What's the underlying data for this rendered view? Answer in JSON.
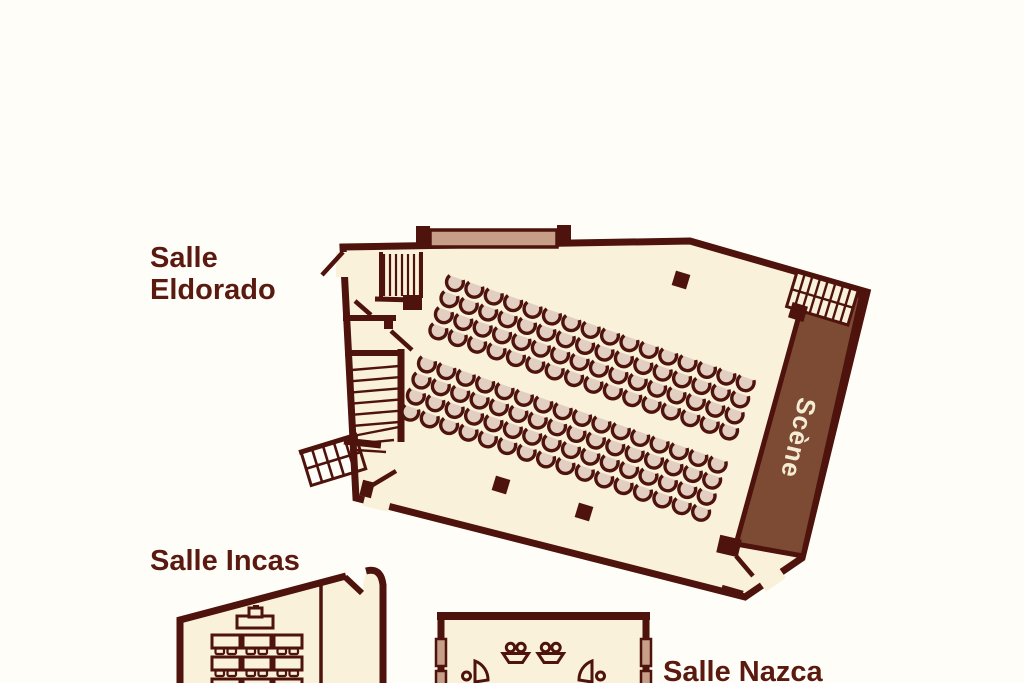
{
  "page": {
    "type": "venue-floor-plan",
    "background": "#fffdf7"
  },
  "palette": {
    "wall": "#4d130c",
    "room_fill": "#f9f1da",
    "seat_fill": "#e3cfc2",
    "stage_fill": "#7d4a34",
    "stage_text": "#f5ecd4",
    "opening_fill": "#c79e88",
    "label_color": "#5a1a10"
  },
  "rooms": {
    "eldorado": {
      "label_line1": "Salle",
      "label_line2": "Eldorado",
      "stage_label": "Scène",
      "seating": {
        "arrangement": "theater",
        "banks": [
          {
            "rows": 4,
            "cols": 16
          },
          {
            "rows": 4,
            "cols": 16
          }
        ],
        "total_seats": 128
      },
      "pillars": 3,
      "stairways": 4
    },
    "incas": {
      "label": "Salle Incas",
      "furniture": {
        "head_tables": 1,
        "table_rows": 3,
        "table_cols": 3,
        "chairs_per_table": 2
      }
    },
    "nazca": {
      "label": "Salle Nazca",
      "fixtures": {
        "sinks": 2,
        "door_leaves": 2,
        "wall_openings": 4
      }
    }
  }
}
